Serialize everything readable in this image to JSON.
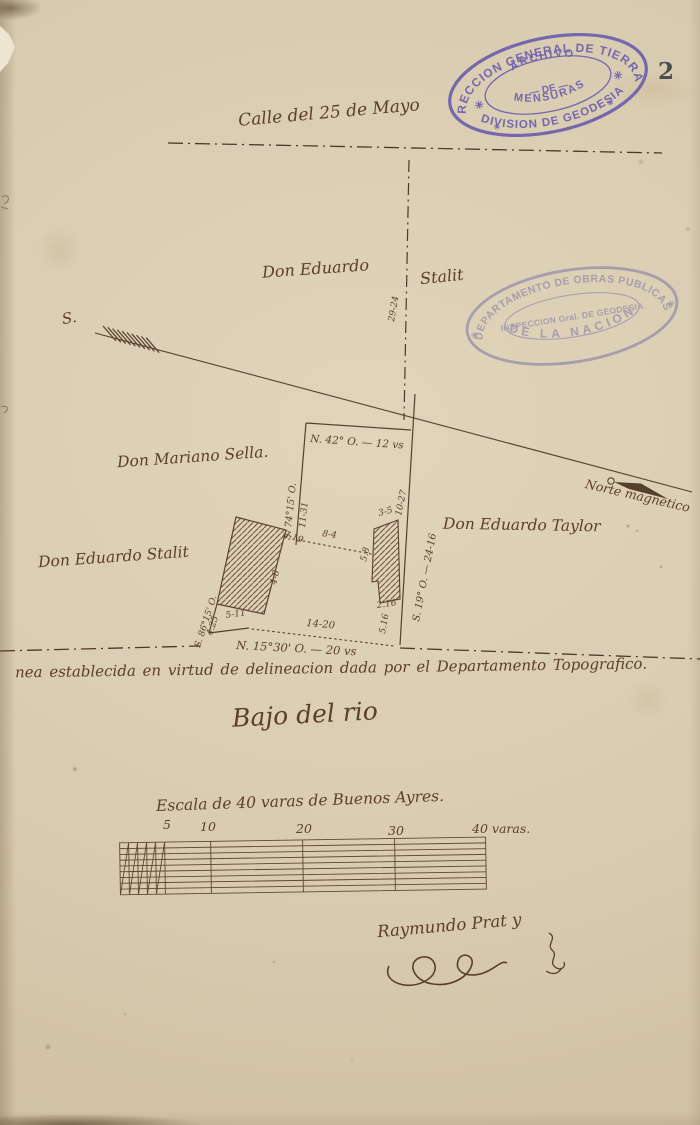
{
  "page_number": "2",
  "colors": {
    "paper": "#d8cbb0",
    "ink": "#5a4029",
    "stamp_archive": "#6d5eae",
    "stamp_obras": "#8f87a8"
  },
  "street": {
    "name": "Calle del 25 de Mayo"
  },
  "owners": {
    "north_left": "Don Eduardo",
    "north_right": "Stalit",
    "west": "Don Mariano Sella.",
    "southwest": "Don Eduardo Stalit",
    "east": "Don Eduardo Taylor"
  },
  "compass": {
    "south": "S.",
    "north": "Norte magnetico"
  },
  "measurements": {
    "frontage_depth": "29-24",
    "top_bearing": "N. 42° O. — 12 vs",
    "west_bearing": "S. 74°15' O.",
    "west_length": "11-31",
    "east_length_upper": "10-27",
    "east_bearing": "S. 19° O. — 24-16",
    "gap": "2-19",
    "parcel_side": "4-8",
    "bottom_left_length": "5-11",
    "corner_length": "4.25",
    "corner_bearing": "S. 86°15' O.",
    "mid_span": "8-4",
    "bottom_span": "14-20",
    "south_bearing": "N. 15°30' O. — 20 vs",
    "east_length_lower": "5.16",
    "small_top": "3-5",
    "small_side": "5.8",
    "small_bottom": "2.16"
  },
  "stamps": {
    "archive": {
      "arc_top": "DIRECCION GENERAL DE TIERRAS",
      "inner_1": "ARCHIVO",
      "inner_2": "— DE —",
      "inner_3": "MENSURAS",
      "arc_bottom": "DIVISION DE GEODESIA",
      "star": "✳"
    },
    "obras": {
      "arc_top": "DEPARTAMENTO DE OBRAS PUBLICAS",
      "inner": "INSPECCION Gral. DE GEODESIA",
      "arc_bottom": "DE LA NACION",
      "star": "✳"
    }
  },
  "notes": {
    "boundary": "nea establecida en virtud de delineacion dada por el Departamento Topografico.",
    "region": "Bajo del rio"
  },
  "scale_bar": {
    "title": "Escala de 40 varas de Buenos Ayres.",
    "ticks": [
      "5",
      "10",
      "20",
      "30",
      "40 varas."
    ]
  },
  "signature": {
    "name": "Raymundo Prat y"
  }
}
